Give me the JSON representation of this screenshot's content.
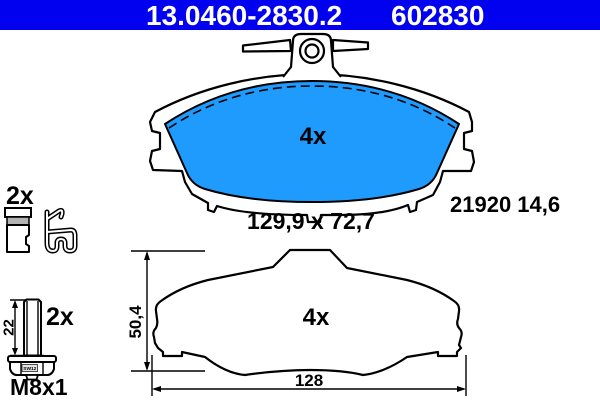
{
  "header": {
    "part_number": "13.0460-2830.2",
    "ref_number": "602830",
    "bg_color": "#0101f0",
    "text_color": "#ffffff"
  },
  "colors": {
    "pad_friction": "#1e9bfc",
    "outline": "#000000",
    "background": "#ffffff"
  },
  "top_view": {
    "qty": "4x",
    "size_label": "129,9 x 72,7",
    "wva_label": "21920 14,6"
  },
  "side_view": {
    "qty": "4x",
    "height_dim": "50,4",
    "width_dim": "128"
  },
  "accessories": {
    "clip_qty": "2x",
    "bolt_qty": "2x",
    "bolt_length_dim": "22",
    "bolt_head_label": "SW12",
    "bolt_thread_label": "M8x1"
  }
}
